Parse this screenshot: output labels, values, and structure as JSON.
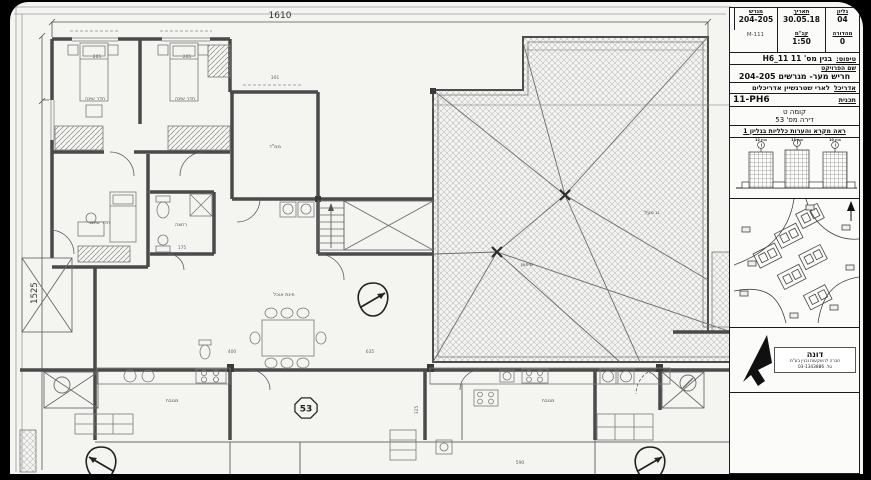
{
  "plan": {
    "dim_top": "1610",
    "dim_left": "1525",
    "badge": "53",
    "rooms": {
      "bedroom1": "חדר שינה",
      "bedroom2": "חדר שינה",
      "bedroom3": "חדר שינה",
      "mamad": "ממ\"ד",
      "dining": "פינת אוכל",
      "kitchen_left": "מטבח",
      "kitchen_right": "מטבח",
      "bath": "רחצה",
      "roof_slope": "שיפוע",
      "roof_note": "גג מעל"
    },
    "dims": [
      "205",
      "205",
      "301",
      "175",
      "635",
      "400",
      "590",
      "325"
    ]
  },
  "titleblock": {
    "info": {
      "sheet_label": "גליון",
      "sheet_value": "04",
      "date_label": "תאריך",
      "date_value": "30.05.18",
      "plot_label": "מגרש",
      "plot_value": "204-205",
      "edition_label": "מהדורה",
      "edition_value": "0",
      "scale_label": "קנ\"מ",
      "scale_value": "1:50",
      "file_value": "M-111"
    },
    "type_label": "טיפוס:",
    "type_value": "בנין מס' 11  11_H6",
    "project_label": "שם הפרויקט",
    "project_value": "חריש מער- מגרשים 204-205",
    "architect_label": "אדריכל",
    "architect_value": "לארי שטרנשיין אדריכלים",
    "plan_label": "תכנית",
    "plan_value": "11-PH6",
    "floor": "קומה ט",
    "apartment": "דירה מס' 53",
    "note": "ראה מקרא והערות כלליות בגליון 1",
    "towers": [
      "בנין 12",
      "בנין 11",
      "בנין 10"
    ],
    "logo": {
      "name": "דונה",
      "line1": "חברה להשקעות ובנין בע\"מ",
      "line2": "טל. 03-1343886"
    }
  }
}
